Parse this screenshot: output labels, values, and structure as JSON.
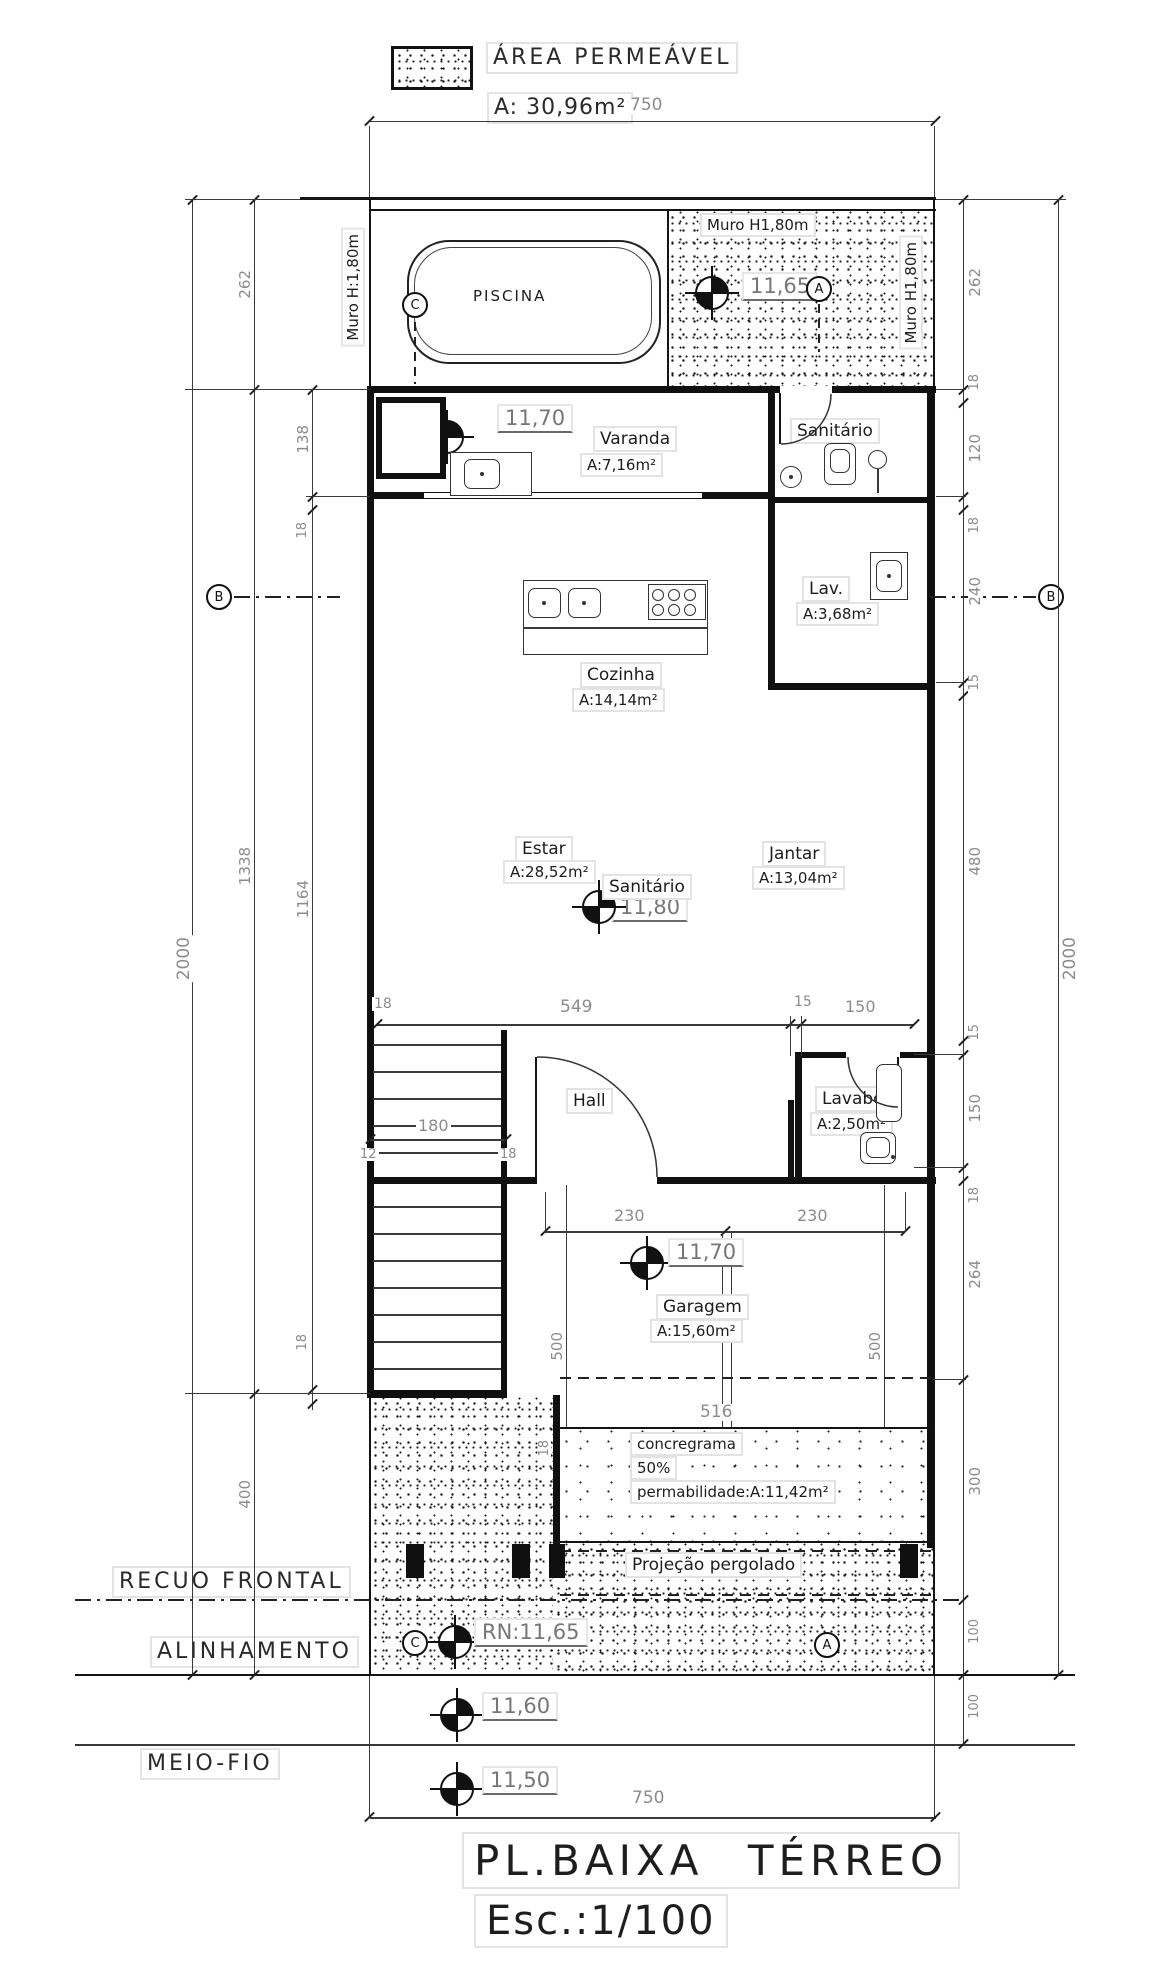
{
  "legend": {
    "title": "ÁREA PERMEÁVEL",
    "area": "A: 30,96m²",
    "swatch_icon": "stipple-hatch-swatch"
  },
  "titleblock": {
    "name": "PL.BAIXA TÉRREO",
    "scale": "Esc.:1/100"
  },
  "site": {
    "recuo": "RECUO FRONTAL",
    "alinhamento": "ALINHAMENTO",
    "meio_fio": "MEIO-FIO"
  },
  "walls": {
    "muro_left": "Muro H:1,80m",
    "muro_top": "Muro H1,80m",
    "muro_right": "Muro H1,80m"
  },
  "rooms": {
    "piscina": "PISCINA",
    "varanda": {
      "name": "Varanda",
      "area": "A:7,16m²"
    },
    "sanitario_sup": "Sanitário",
    "lav": {
      "name": "Lav.",
      "area": "A:3,68m²"
    },
    "cozinha": {
      "name": "Cozinha",
      "area": "A:14,14m²"
    },
    "estar": {
      "name": "Estar",
      "area": "A:28,52m²"
    },
    "jantar": {
      "name": "Jantar",
      "area": "A:13,04m²"
    },
    "sanitario_centro": "Sanitário",
    "hall": "Hall",
    "lavabo": {
      "name": "Lavabo",
      "area": "A:2,50m²"
    },
    "garagem": {
      "name": "Garagem",
      "area": "A:15,60m²"
    }
  },
  "levels": {
    "l1165": "11,65",
    "l1170": "11,70",
    "l1180": "11,80",
    "rn": "RN:11,65",
    "l1160": "11,60",
    "l1150": "11,50"
  },
  "notes": {
    "concregrama_1": "concregrama",
    "concregrama_2": "50%",
    "concregrama_3": "permabilidade:A:11,42m²",
    "pergolado": "Projeção pergolado"
  },
  "markers": {
    "a": "A",
    "b": "B",
    "c": "C"
  },
  "dims": {
    "d750": "750",
    "d262": "262",
    "d138": "138",
    "d18": "18",
    "d2000": "2000",
    "d1338": "1338",
    "d1164": "1164",
    "d400": "400",
    "d120": "120",
    "d240": "240",
    "d15": "15",
    "d480": "480",
    "d150": "150",
    "d264": "264",
    "d300": "300",
    "d100": "100",
    "d549": "549",
    "d230": "230",
    "d500": "500",
    "d516": "516",
    "d180": "180",
    "d12": "12"
  }
}
